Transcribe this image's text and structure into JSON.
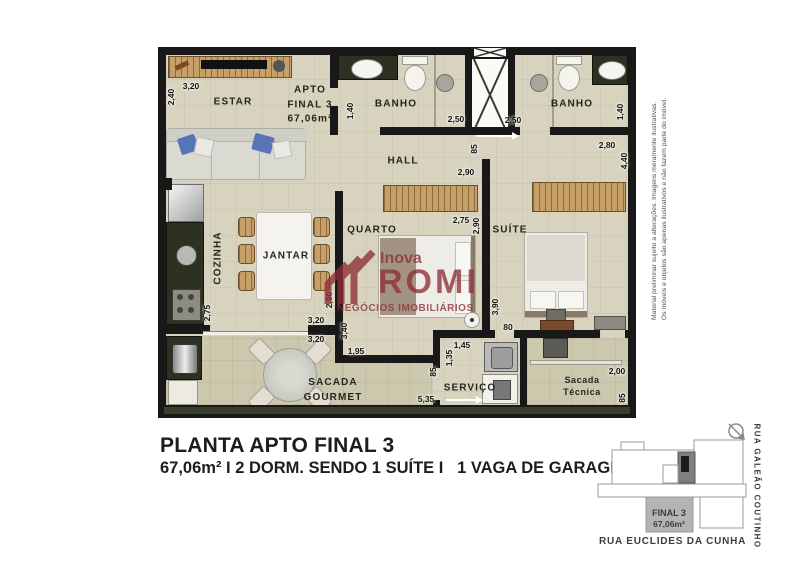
{
  "plan": {
    "unit_label": {
      "line1": "APTO",
      "line2": "FINAL 3",
      "line3": "67,06m²"
    },
    "rooms": {
      "estar": "ESTAR",
      "banho": "BANHO",
      "hall": "HALL",
      "quarto": "QUARTO",
      "suite": "SUÍTE",
      "cozinha": "COZINHA",
      "jantar": "JANTAR",
      "sacada_gourmet": [
        "SACADA",
        "GOURMET"
      ],
      "servico": "SERVIÇO",
      "sacada_tecnica": [
        "Sacada",
        "Técnica"
      ]
    },
    "dims": {
      "estar_w": "3,20",
      "estar_h": "2,40",
      "banho1_h": "1,40",
      "banho1_w": "2,50",
      "banho2_w": "2,50",
      "banho2_h": "1,40",
      "suite_top": "2,80",
      "suite_side": "4,40",
      "hall_w": "85",
      "hall_len": "2,90",
      "quarto_w": "2,75",
      "quarto_h": "2,90",
      "jantar_h": "2,90",
      "jantar_w": "3,20",
      "sacada_w": "3,20",
      "sacada_h": "3,40",
      "sacada_seg": "1,95",
      "sacada_len": "5,35",
      "cozinha_h": "2,75",
      "suite_len": "3,90",
      "suite_door": "80",
      "servico_w": "1,45",
      "servico_h": "1,35",
      "servico_pass": "85",
      "tecnica_w": "2,00",
      "tecnica_h": "85"
    }
  },
  "watermark": {
    "brand_top": "Inova",
    "brand": "ROMI",
    "tagline": "NEGÓCIOS IMOBILIÁRIOS"
  },
  "disclaimer": {
    "line1": "Material preliminar sujeito a alterações. Imagens meramente ilustrativas.",
    "line2": "Os móveis e objetos são apenas ilustrativos e não fazem parte do imóvel."
  },
  "footer": {
    "title": "PLANTA APTO FINAL 3",
    "subtitle": "67,06m² I 2 DORM. SENDO 1 SUÍTE I   1 VAGA DE GARAGEM"
  },
  "keyplan": {
    "unit": "FINAL 3",
    "area": "67,06m²",
    "street_right": "RUA GALEÃO COUTINHO",
    "street_bottom": "RUA EUCLIDES DA CUNHA"
  },
  "colors": {
    "wall": "#181818",
    "floor": "#d7d3bf",
    "balcony_floor": "#ccc8ae",
    "wood": "#c79f68",
    "counter": "#2c3122",
    "watermark": "#8e2f37",
    "pillow_blue": "#5874b8",
    "keyplan_unit_fill": "#b4b4b4"
  }
}
